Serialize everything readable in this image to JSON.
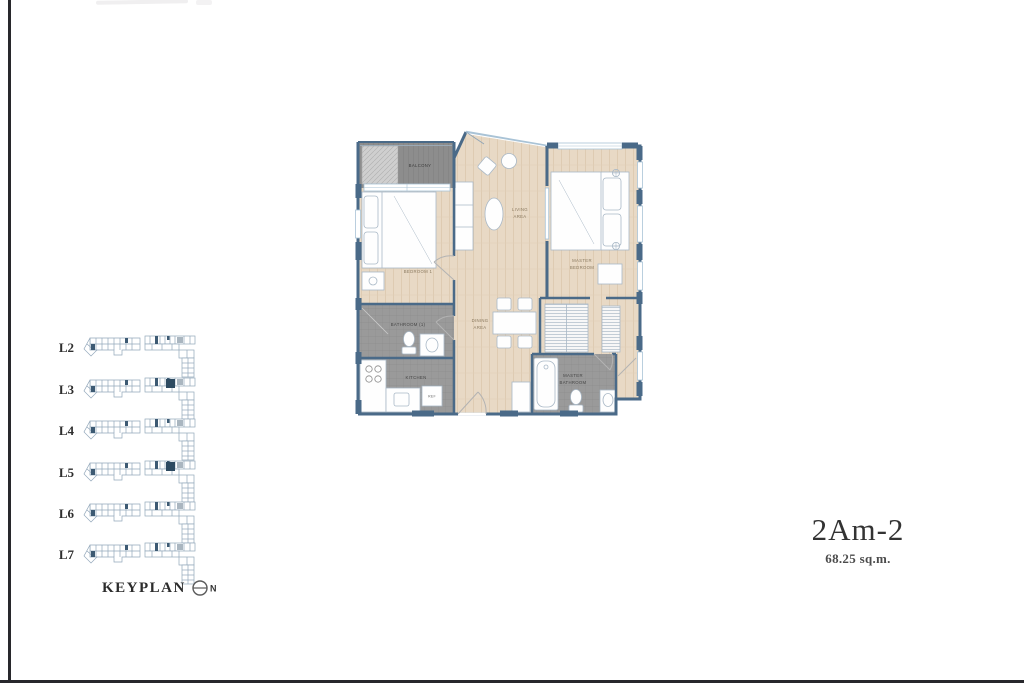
{
  "page": {
    "left_border_color": "#28282c",
    "bottom_border_color": "#28282c",
    "background": "#ffffff"
  },
  "unit": {
    "name": "2Am-2",
    "area": "68.25 sq.m."
  },
  "keyplan": {
    "title": "KEYPLAN",
    "north_label": "N",
    "highlight_color": "#2d4a61",
    "levels": [
      {
        "label": "L2",
        "highlighted": false
      },
      {
        "label": "L3",
        "highlighted": true
      },
      {
        "label": "L4",
        "highlighted": false
      },
      {
        "label": "L5",
        "highlighted": true
      },
      {
        "label": "L6",
        "highlighted": false
      },
      {
        "label": "L7",
        "highlighted": false
      }
    ]
  },
  "floorplan": {
    "colors": {
      "wall": "#4a6a88",
      "window": "#a9c3d6",
      "wood_floor": "#e8d9c5",
      "tile_floor": "#9a9a9a",
      "balcony_floor": "#8d8d8d"
    },
    "labels": {
      "balcony": "BALCONY",
      "bedroom1": "BEDROOM 1",
      "living_line1": "LIVING",
      "living_line2": "AREA",
      "master_line1": "MASTER",
      "master_line2": "BEDROOM",
      "dining_line1": "DINING",
      "dining_line2": "AREA",
      "bathroom1": "BATHROOM (1)",
      "kitchen": "KITCHEN",
      "ref": "REF",
      "master_bath_line1": "MASTER",
      "master_bath_line2": "BATHROOM"
    }
  }
}
